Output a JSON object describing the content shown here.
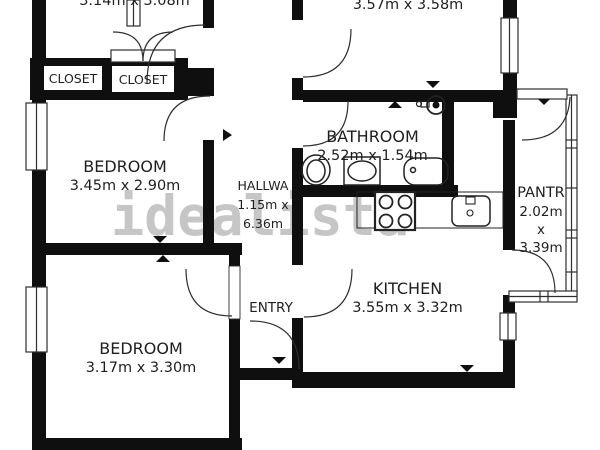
{
  "watermark": {
    "text": "idealista",
    "color": "#c6c6c6"
  },
  "colors": {
    "wall": "#0f0f0f",
    "line": "#2e2e2e",
    "text": "#1f1f1f",
    "background": "#ffffff"
  },
  "rooms": {
    "top_left": {
      "dims": "3.14m x 3.08m"
    },
    "top_right": {
      "dims": "3.57m x 3.58m"
    },
    "bathroom": {
      "name": "BATHROOM",
      "dims": "2.52m x 1.54m"
    },
    "hallway": {
      "name": "HALLWA",
      "dims_line1": "1.15m x",
      "dims_line2": "6.36m"
    },
    "bedroom_middle": {
      "name": "BEDROOM",
      "dims": "3.45m x 2.90m"
    },
    "bedroom_bottom": {
      "name": "BEDROOM",
      "dims": "3.17m x 3.30m"
    },
    "entry": {
      "name": "ENTRY"
    },
    "kitchen": {
      "name": "KITCHEN",
      "dims": "3.55m x 3.32m"
    },
    "pantry": {
      "name": "PANTR",
      "dims_line1": "2.02m",
      "dims_line2": "x",
      "dims_line3": "3.39m"
    },
    "closet_left": {
      "name": "CLOSET"
    },
    "closet_right": {
      "name": "CLOSET"
    }
  }
}
